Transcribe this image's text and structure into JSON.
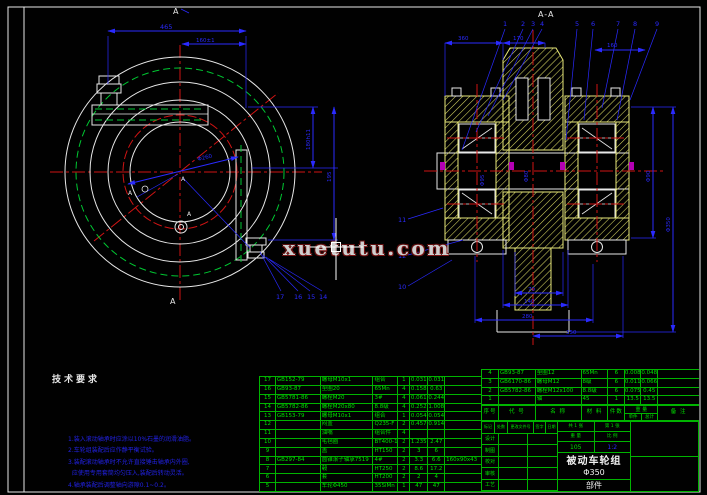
{
  "watermark": "xuetutu.com",
  "left_view": {
    "section_label_top": "A",
    "section_label_bottom": "A",
    "datum_center": "A",
    "datum_left": "A",
    "datum_bottom": "A",
    "dims": {
      "width": "465",
      "inner_width": "160±1",
      "height1": "180h11",
      "height2": "195",
      "diameter": "Φ260"
    },
    "callouts": [
      "17",
      "16",
      "15",
      "14"
    ]
  },
  "section_view": {
    "title": "A-A",
    "callouts_top": [
      "1",
      "2",
      "3",
      "4",
      "5",
      "6",
      "7",
      "8",
      "9"
    ],
    "callouts_left": [
      "11",
      "12",
      "10"
    ],
    "dims_top": [
      "360",
      "170",
      "160"
    ],
    "dims_bottom": [
      "70",
      "140",
      "280",
      "350"
    ],
    "dims_right": [
      "Φ90",
      "Φ350"
    ],
    "dims_inner": [
      "Φ80",
      "Φ95"
    ]
  },
  "tech_requirements": {
    "title": "技术要求",
    "lines": [
      "1.装入滚动轴承时应涂以10%石墨的润滑油脂。",
      "2.车轮组装配后应作静平衡试验。",
      "3.装配滚动轴承时不允许直接锤击轴承内外圈,",
      "  应使用专用套筒均匀压入,装配后转动灵活。",
      "4.轴承装配后调整轴向游隙0.1~0.2。"
    ]
  },
  "parts_table": {
    "headers": {
      "no": "序号",
      "code": "代  号",
      "name": "名  称",
      "material": "材 料",
      "qty": "件数",
      "weight": "重 量",
      "unit": "单件",
      "total": "总计",
      "note": "备 注"
    },
    "rows_left": [
      {
        "no": "17",
        "code": "GB152-79",
        "name": "螺母M10x1",
        "material": "组合",
        "qty": "1",
        "unit": "0.031",
        "total": "0.031",
        "note": ""
      },
      {
        "no": "16",
        "code": "GB93-87",
        "name": "垫圈20",
        "material": "65Mn",
        "qty": "4",
        "unit": "0.158",
        "total": "0.63",
        "note": ""
      },
      {
        "no": "15",
        "code": "GB5781-86",
        "name": "螺栓M20",
        "material": "3#",
        "qty": "4",
        "unit": "0.061",
        "total": "0.244",
        "note": ""
      },
      {
        "no": "14",
        "code": "GB5782-86",
        "name": "螺栓M20x80",
        "material": "8.8级",
        "qty": "4",
        "unit": "0.252",
        "total": "1.008",
        "note": ""
      },
      {
        "no": "13",
        "code": "GB153-79",
        "name": "螺母M10x1",
        "material": "组合",
        "qty": "1",
        "unit": "0.054",
        "total": "0.054",
        "note": ""
      },
      {
        "no": "12",
        "code": "",
        "name": "闷盖",
        "material": "Q235-F",
        "qty": "2",
        "unit": "0.457",
        "total": "0.914",
        "note": ""
      },
      {
        "no": "11",
        "code": "",
        "name": "油嘴",
        "material": "组合件",
        "qty": "4",
        "unit": "",
        "total": "",
        "note": ""
      },
      {
        "no": "10",
        "code": "",
        "name": "毛毡圈",
        "material": "BT400-15",
        "qty": "2",
        "unit": "1.235",
        "total": "2.47",
        "note": ""
      },
      {
        "no": "9",
        "code": "",
        "name": "盖",
        "material": "HT150",
        "qty": "2",
        "unit": "3",
        "total": "6",
        "note": ""
      },
      {
        "no": "8",
        "code": "GB297-84",
        "name": "圆锥滚子轴承7519",
        "material": "4#",
        "qty": "2",
        "unit": "3.3",
        "total": "6.6",
        "note": "160x90x43"
      },
      {
        "no": "7",
        "code": "",
        "name": "毂",
        "material": "HT250",
        "qty": "2",
        "unit": "8.6",
        "total": "17.2",
        "note": ""
      },
      {
        "no": "6",
        "code": "",
        "name": "套",
        "material": "HT200",
        "qty": "2",
        "unit": "2",
        "total": "4",
        "note": ""
      },
      {
        "no": "5",
        "code": "",
        "name": "车轮Φ450",
        "material": "35SiMn",
        "qty": "1",
        "unit": "47",
        "total": "47",
        "note": ""
      }
    ],
    "rows_right": [
      {
        "no": "4",
        "code": "GB93-87",
        "name": "垫圈12",
        "material": "65Mn",
        "qty": "6",
        "unit": "0.008",
        "total": "0.048",
        "note": ""
      },
      {
        "no": "3",
        "code": "GB6170-86",
        "name": "螺母M12",
        "material": "8级",
        "qty": "6",
        "unit": "0.011",
        "total": "0.066",
        "note": ""
      },
      {
        "no": "2",
        "code": "GB5782-86",
        "name": "螺栓M12x100",
        "material": "8.8级",
        "qty": "6",
        "unit": "0.075",
        "total": "0.45",
        "note": ""
      },
      {
        "no": "1",
        "code": "",
        "name": "轴",
        "material": "45",
        "qty": "1",
        "unit": "13.5",
        "total": "13.5",
        "note": ""
      }
    ]
  },
  "title_block": {
    "admin_header": [
      "标记",
      "处数",
      "更改文件号",
      "签字",
      "日期"
    ],
    "admin_rows": [
      "设计",
      "制图",
      "校对",
      "审核",
      "工艺"
    ],
    "sheet1": "共 1 张",
    "sheet2": "第 1 张",
    "weight_label": "重 量",
    "scale_label": "比 例",
    "weight_value": "105",
    "scale_value": "1:2",
    "title_line1": "被动车轮组",
    "title_line2": "Φ350",
    "subtitle": "部件"
  }
}
